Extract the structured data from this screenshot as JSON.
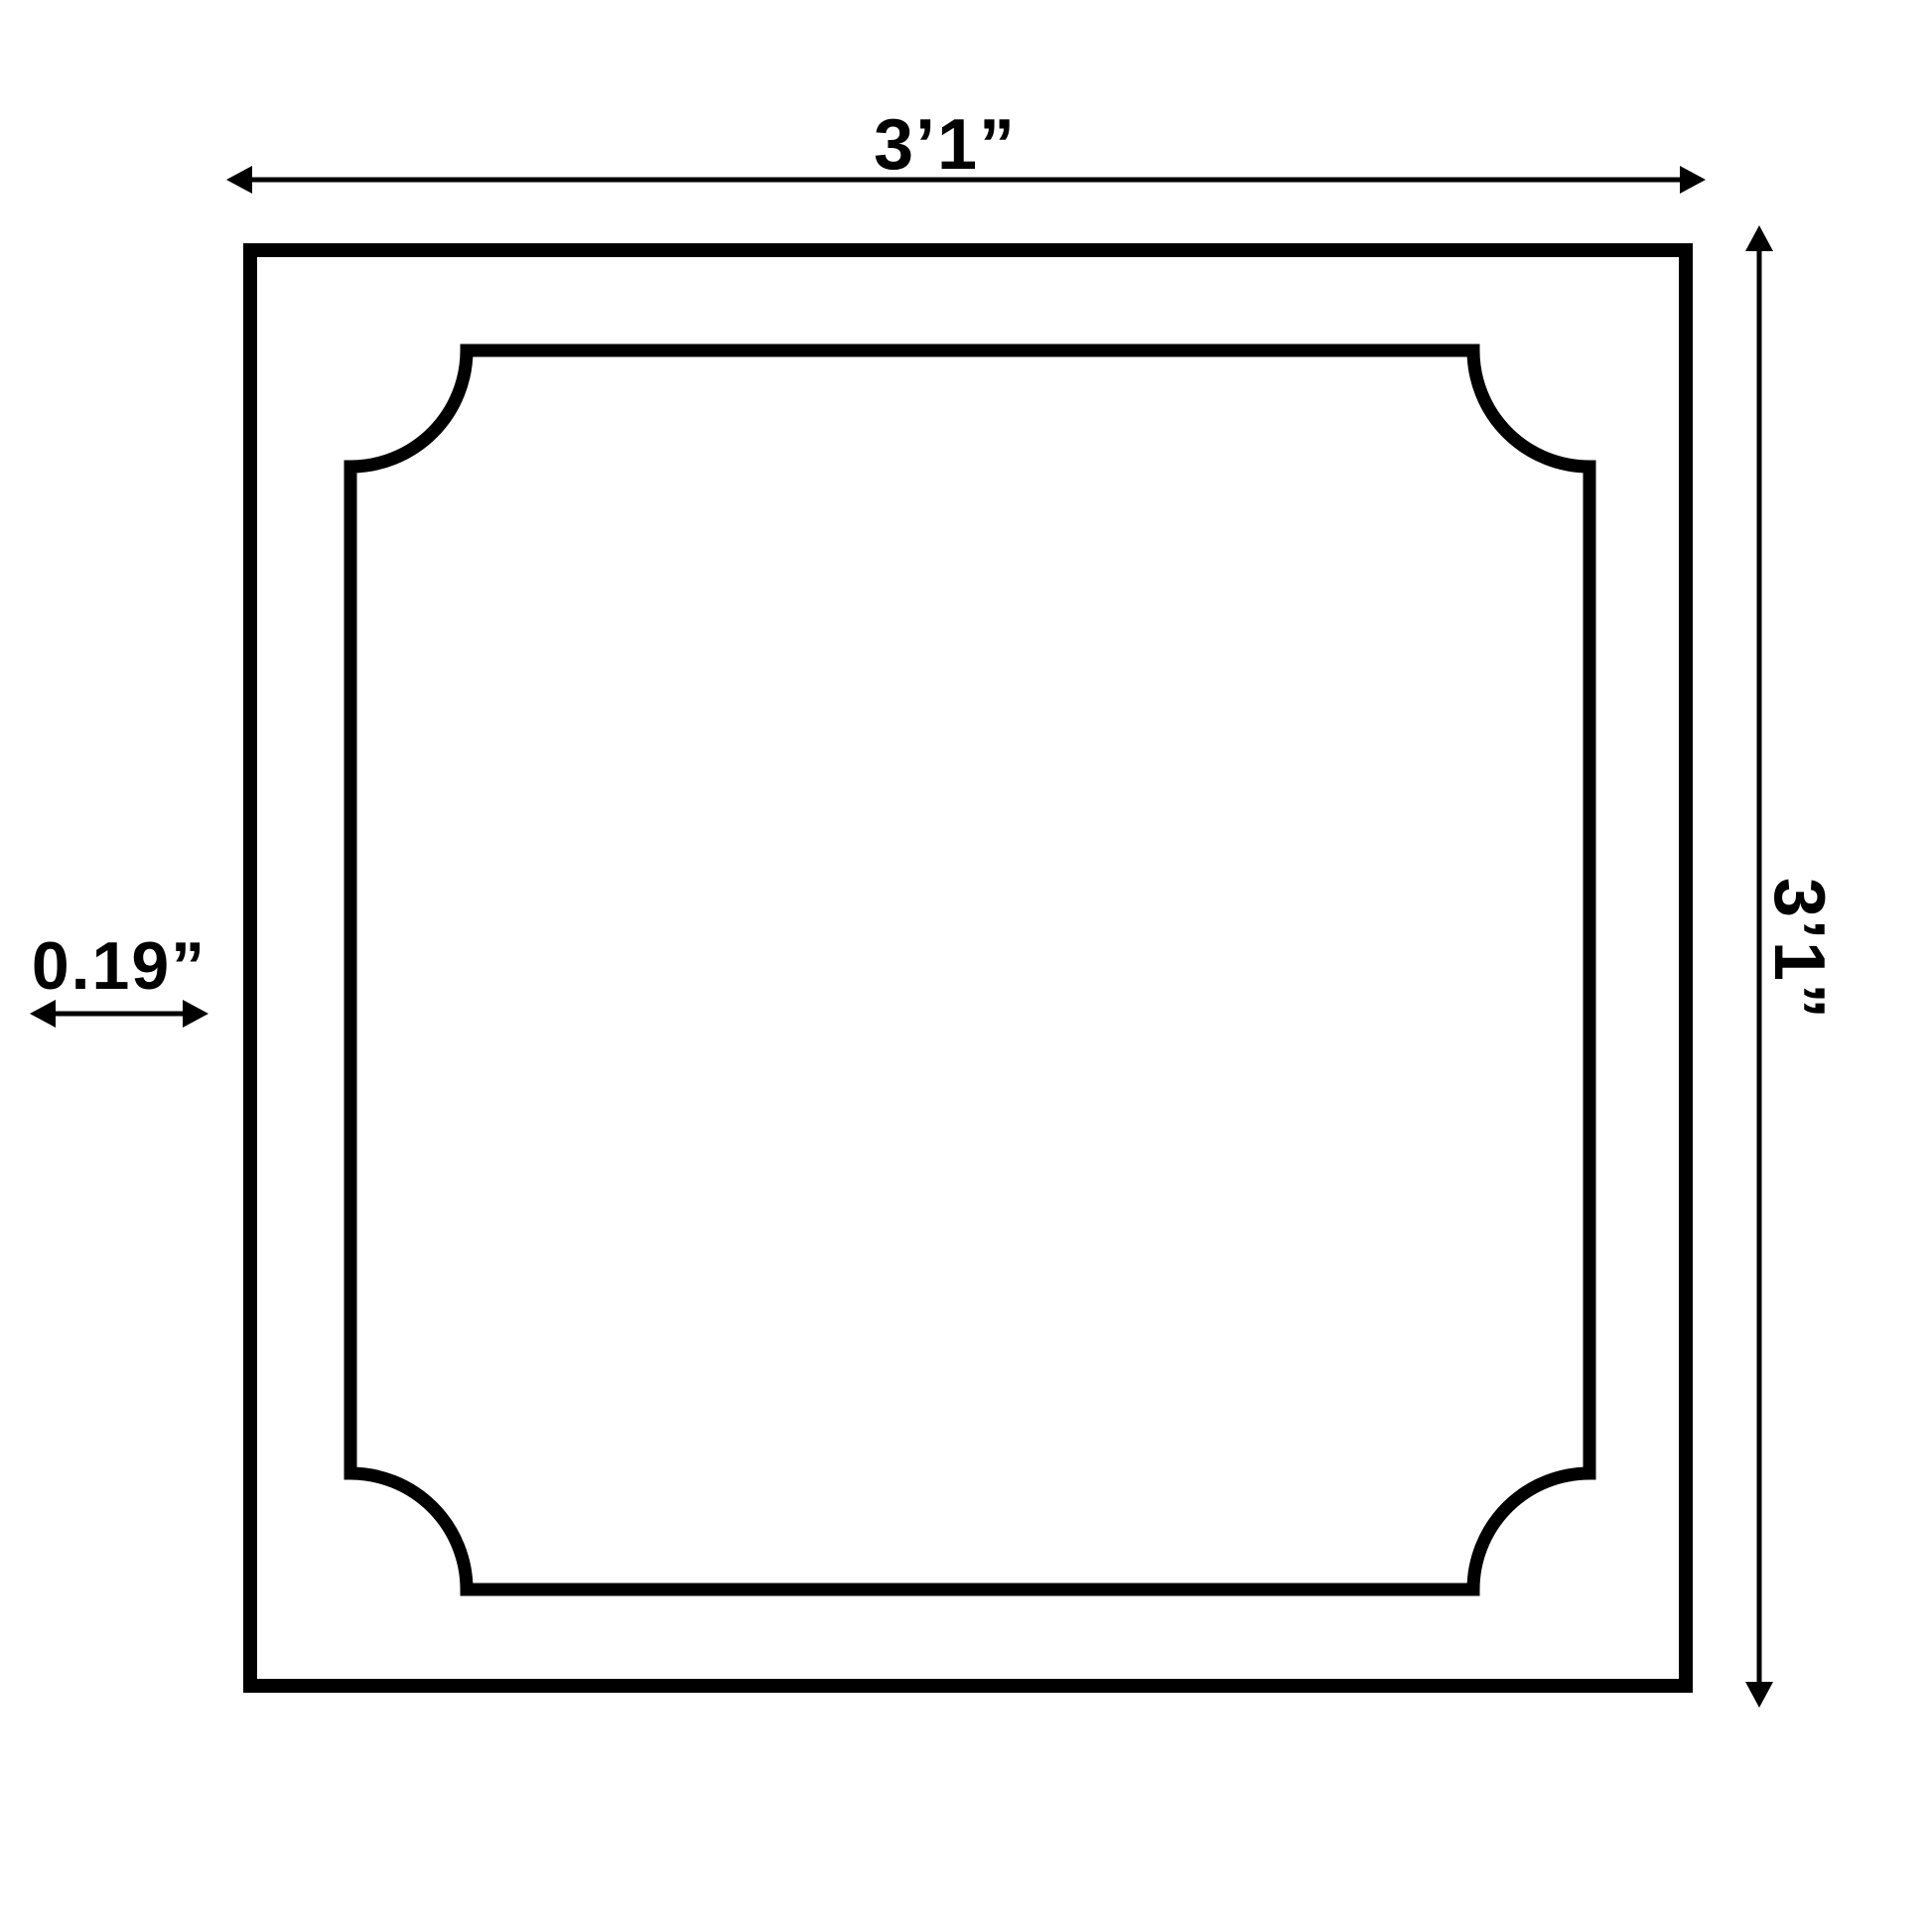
{
  "page": {
    "background": "#ffffff"
  },
  "diagram": {
    "type": "dimension-drawing",
    "line_color": "#000000",
    "width_dimension": {
      "label": "3’1”"
    },
    "height_dimension": {
      "label": "3’1”"
    },
    "thickness_dimension": {
      "label": "0.19”"
    },
    "icons": [
      "arrow-left-icon",
      "arrow-right-icon",
      "arrow-up-icon",
      "arrow-down-icon",
      "double-arrow-icon"
    ]
  }
}
